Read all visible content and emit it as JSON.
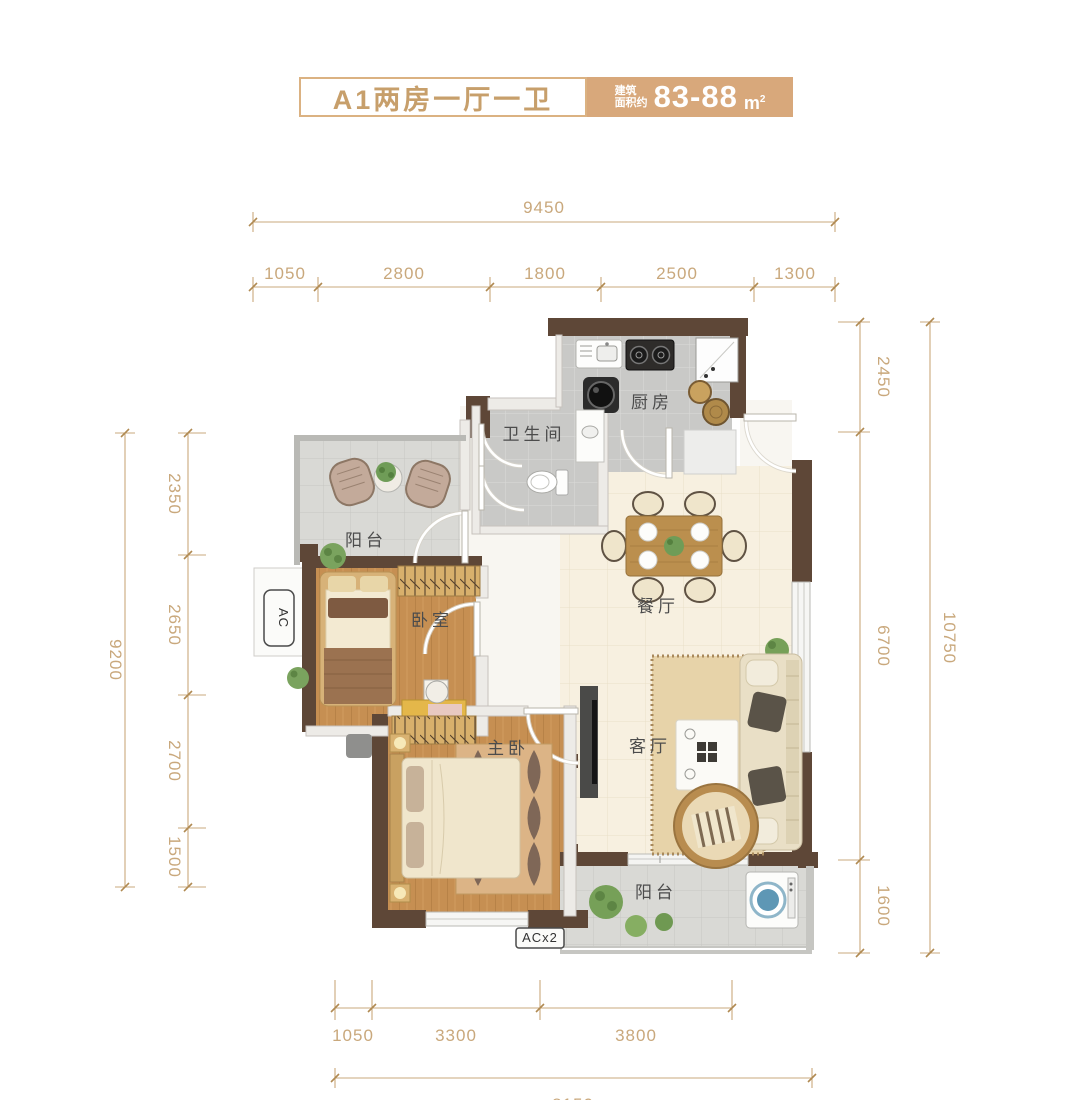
{
  "header": {
    "title": "A1两房一厅一卫",
    "area_label_line1": "建筑",
    "area_label_line2": "面积约",
    "area_value": "83-88",
    "area_unit_base": "m",
    "area_unit_sup": "2"
  },
  "rooms": {
    "kitchen": "厨房",
    "bathroom": "卫生间",
    "balcony_top": "阳台",
    "bedroom": "卧室",
    "master_bedroom": "主卧",
    "dining": "餐厅",
    "living": "客厅",
    "balcony_bottom": "阳台"
  },
  "equipment": {
    "ac": "AC",
    "ac2": "ACx2"
  },
  "dimensions": {
    "top": {
      "total": "9450",
      "segments": [
        "1050",
        "2800",
        "1800",
        "2500",
        "1300"
      ]
    },
    "left": {
      "total": "9200",
      "segments": [
        "2350",
        "2650",
        "2700",
        "1500"
      ]
    },
    "right": {
      "total": "10750",
      "segments": [
        "2450",
        "6700",
        "1600"
      ]
    },
    "bottom": {
      "total": "8150",
      "segments": [
        "1050",
        "3300",
        "3800"
      ]
    }
  },
  "colors": {
    "accent": "#d8a87b",
    "wall": "#5e4737",
    "dimension": "#c9a87c"
  }
}
